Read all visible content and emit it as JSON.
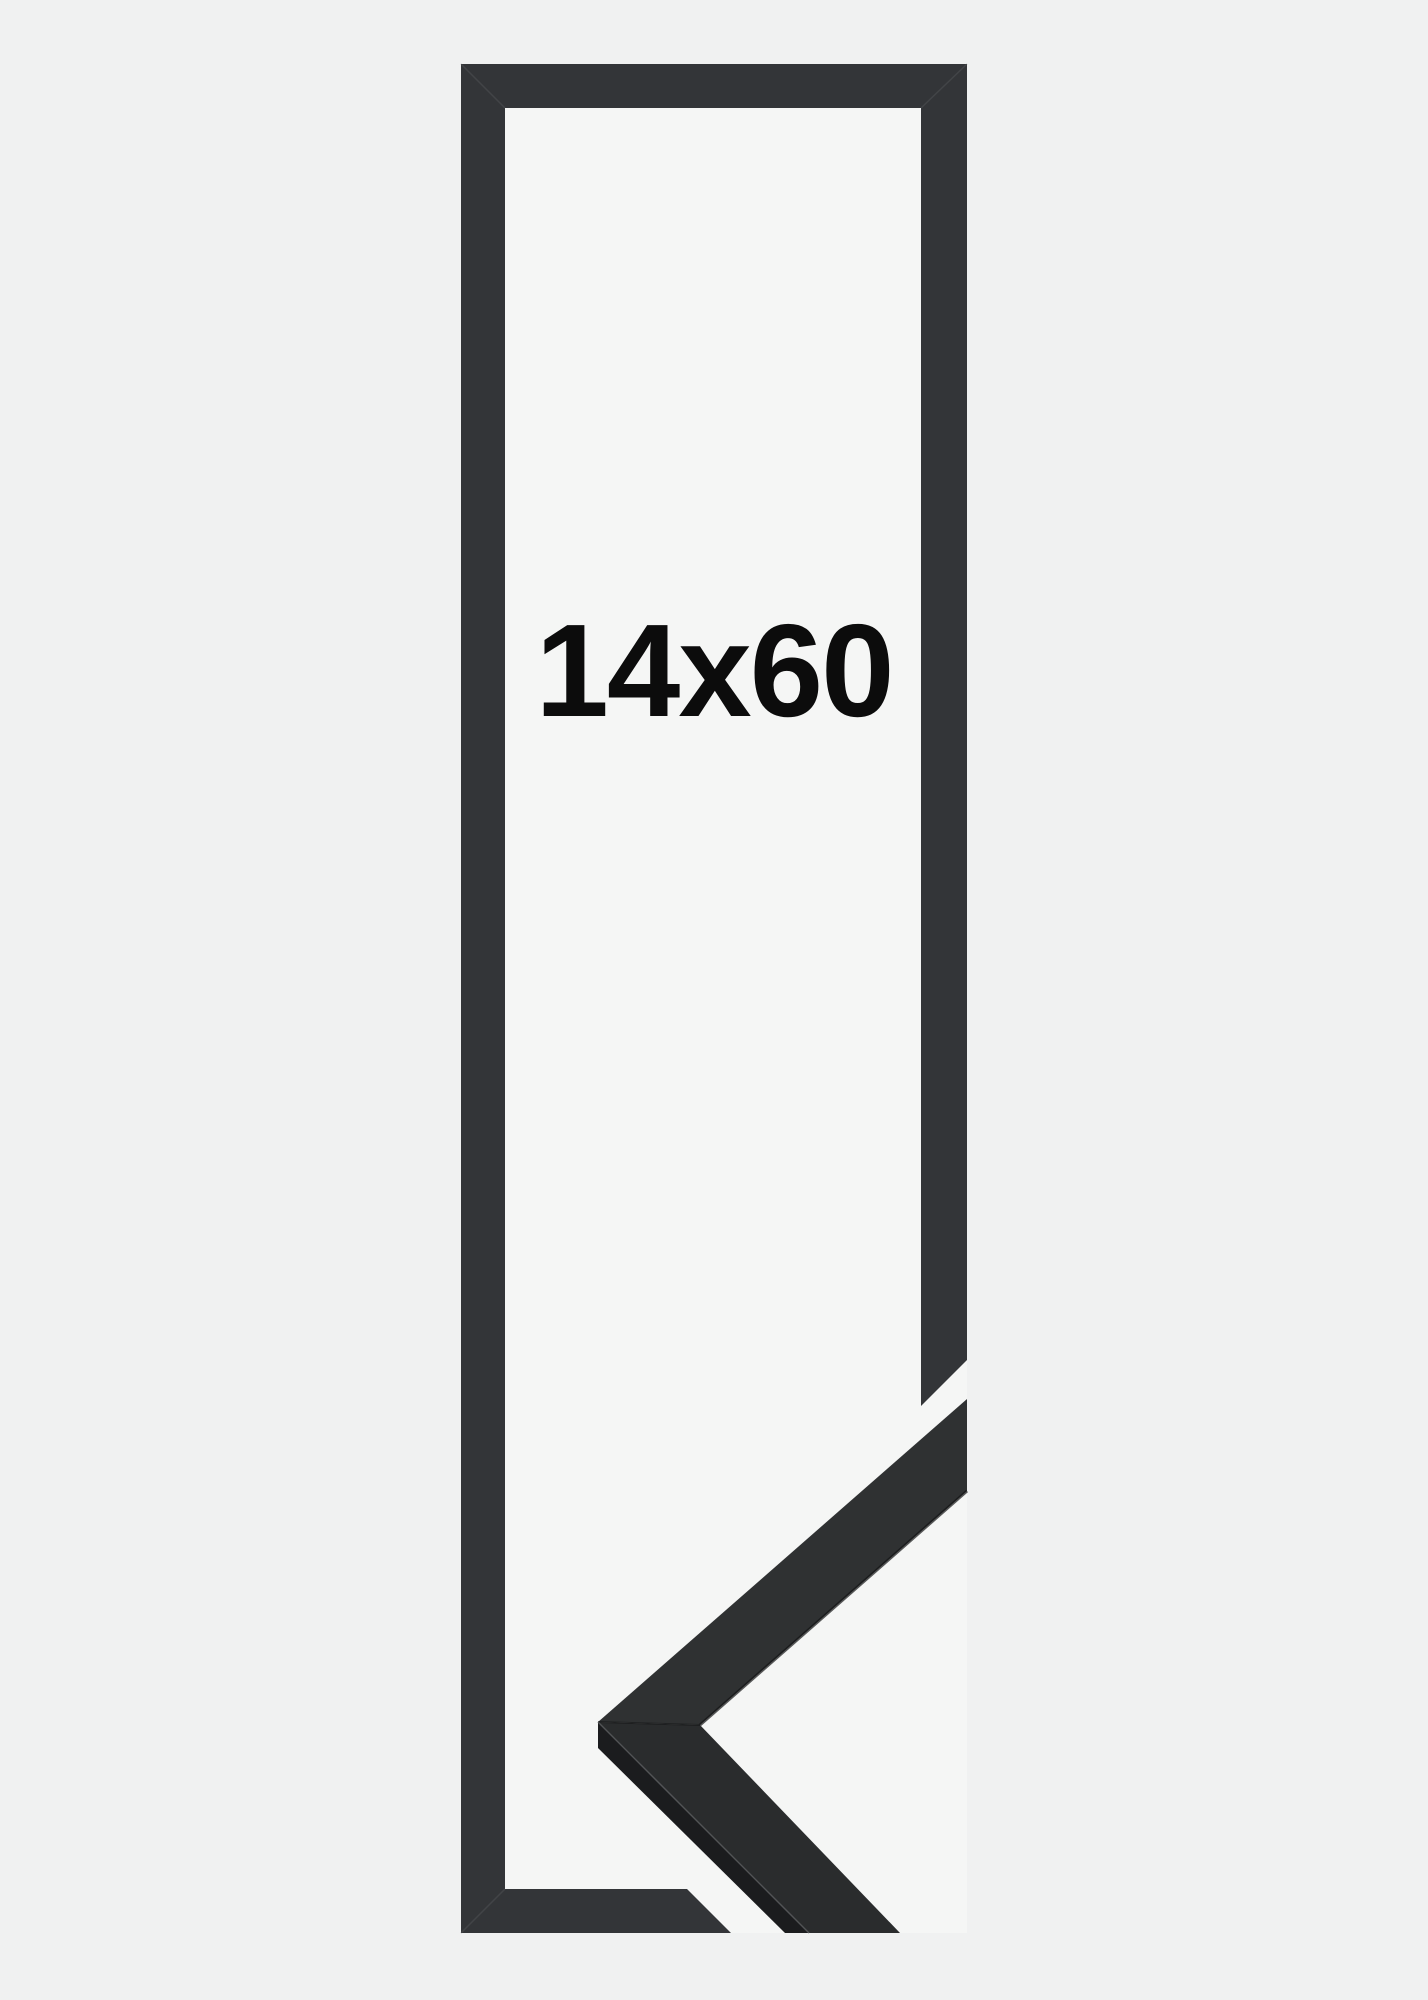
{
  "product_image": {
    "size_label": "14x60"
  },
  "colors": {
    "page_background": "#f0f1f1",
    "frame_interior": "#f5f6f5",
    "frame_bar": "#333538",
    "corner_sample_face_upper": "#2f3132",
    "corner_sample_face_lower": "#2a2c2d",
    "corner_sample_side": "#1b1c1e",
    "miter_seam": "#595c5e",
    "sample_inner_edge": "#131415",
    "sample_facet_highlight": "#56595b",
    "label_color": "#0c0c0c"
  }
}
